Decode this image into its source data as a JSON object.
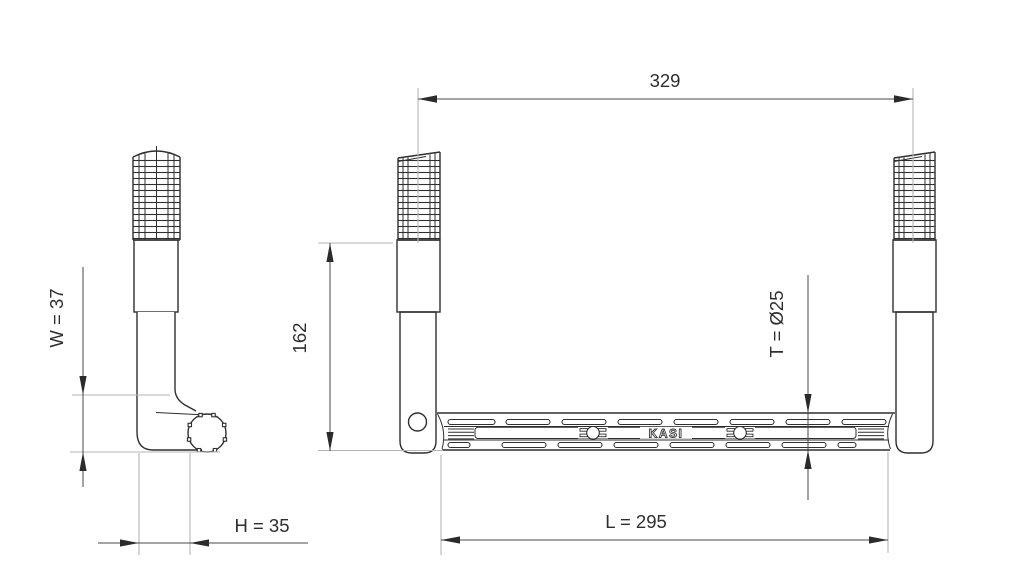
{
  "drawing": {
    "brand_label": "KASI",
    "dimensions": {
      "span_between_legs": "329",
      "leg_height": "162",
      "side_width": "W = 37",
      "side_offset": "H = 35",
      "tube_diameter": "T = Ø25",
      "step_length": "L = 295"
    },
    "colors": {
      "object_line": "#2f2f2f",
      "dimension_line": "#4a4a4a",
      "extension_line": "#b5b5b5",
      "background": "#ffffff"
    }
  }
}
